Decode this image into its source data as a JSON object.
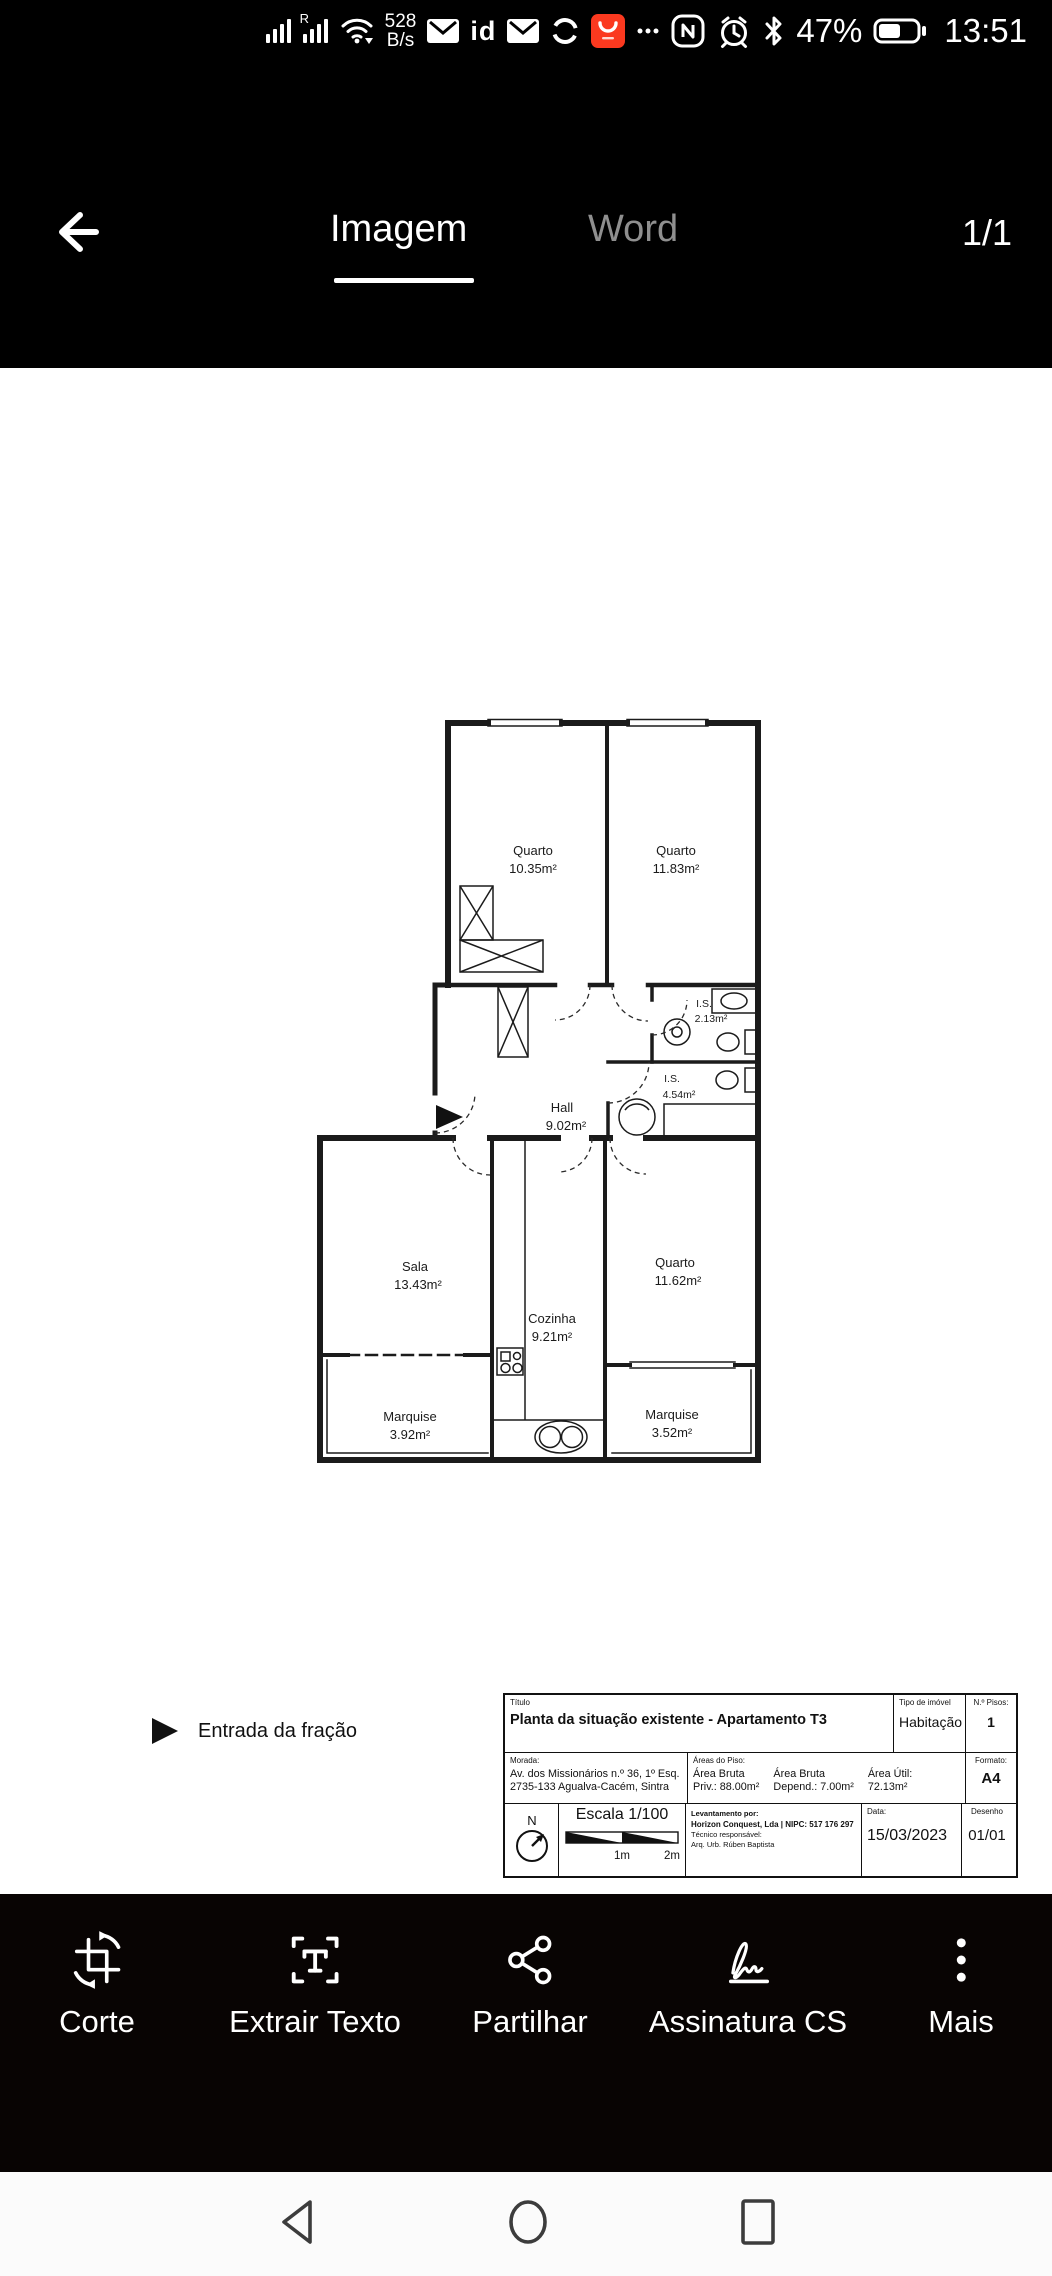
{
  "status_bar": {
    "roaming_indicator": "R",
    "network_speed": "528",
    "network_speed_unit": "B/s",
    "id_badge": "id",
    "more_dots": "···",
    "battery_percent": "47%",
    "time": "13:51",
    "accent_red": "#fb391f"
  },
  "header": {
    "tabs": [
      {
        "label": "Imagem",
        "active": true
      },
      {
        "label": "Word",
        "active": false
      }
    ],
    "page_indicator": "1/1"
  },
  "floorplan": {
    "rooms": [
      {
        "name": "Quarto",
        "area": "10.35m²"
      },
      {
        "name": "Quarto",
        "area": "11.83m²"
      },
      {
        "name": "I.S.",
        "area": "2.13m²"
      },
      {
        "name": "I.S.",
        "area": "4.54m²"
      },
      {
        "name": "Hall",
        "area": "9.02m²"
      },
      {
        "name": "Sala",
        "area": "13.43m²"
      },
      {
        "name": "Cozinha",
        "area": "9.21m²"
      },
      {
        "name": "Quarto",
        "area": "11.62m²"
      },
      {
        "name": "Marquise",
        "area": "3.92m²"
      },
      {
        "name": "Marquise",
        "area": "3.52m²"
      }
    ],
    "entrance_legend": "Entrada da fração"
  },
  "titleblock": {
    "titulo_label": "Título",
    "titulo": "Planta da situação existente - Apartamento T3",
    "tipo_label": "Tipo de imóvel",
    "tipo": "Habitação",
    "pisos_label": "N.º Pisos:",
    "pisos": "1",
    "morada_label": "Morada:",
    "morada_line1": "Av. dos Missionários n.º 36, 1º Esq.",
    "morada_line2": "2735-133 Agualva-Cacém, Sintra",
    "areas_label": "Áreas do Piso:",
    "area1_l1": "Área Bruta",
    "area1_l2": "Priv.: 88.00m²",
    "area2_l1": "Área Bruta",
    "area2_l2": "Depend.: 7.00m²",
    "area3_l1": "Área Útil:",
    "area3_l2": "72.13m²",
    "formato_label": "Formato:",
    "formato": "A4",
    "north": "N",
    "escala": "Escala 1/100",
    "scale_1m": "1m",
    "scale_2m": "2m",
    "levantamento_label": "Levantamento por:",
    "levantamento": "Horizon Conquest, Lda | NIPC: 517 176 297",
    "tecnico_label": "Técnico responsável:",
    "tecnico": "Arq. Urb. Rúben Baptista",
    "data_label": "Data:",
    "data": "15/03/2023",
    "desenho_label": "Desenho",
    "desenho": "01/01"
  },
  "toolbar": {
    "items": [
      "Corte",
      "Extrair Texto",
      "Partilhar",
      "Assinatura CS",
      "Mais"
    ]
  }
}
